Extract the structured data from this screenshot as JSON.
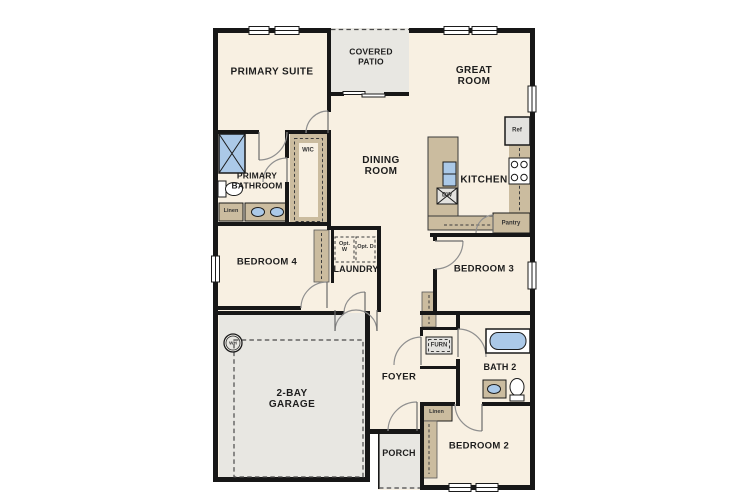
{
  "title": "Single-story floor plan",
  "colors": {
    "floor": "#f8f0e2",
    "outdoor": "#e8e7e2",
    "cabinet": "#cbbc9f",
    "fixture": "#abc9e8",
    "appliance": "#e3e2df",
    "wall": "#171717",
    "arc": "#8f8f8f"
  },
  "labels": {
    "primary_suite": "PRIMARY SUITE",
    "covered_patio": "COVERED PATIO",
    "great_room": "GREAT ROOM",
    "dining_room": "DINING ROOM",
    "kitchen": "KITCHEN",
    "primary_bathroom": "PRIMARY BATHROOM",
    "wic": "WIC",
    "bedroom4": "BEDROOM 4",
    "laundry": "LAUNDRY",
    "opt_w": "Opt. W",
    "opt_d": "Opt. D",
    "bedroom3": "BEDROOM 3",
    "pantry": "Pantry",
    "ref": "Ref",
    "dw": "DW",
    "linen_bath": "Linen",
    "linen_bed2": "Linen",
    "garage": "2-BAY GARAGE",
    "wh": "WH",
    "foyer": "FOYER",
    "furn": "FURN",
    "bath2": "BATH 2",
    "bedroom2": "BEDROOM 2",
    "porch": "PORCH"
  }
}
